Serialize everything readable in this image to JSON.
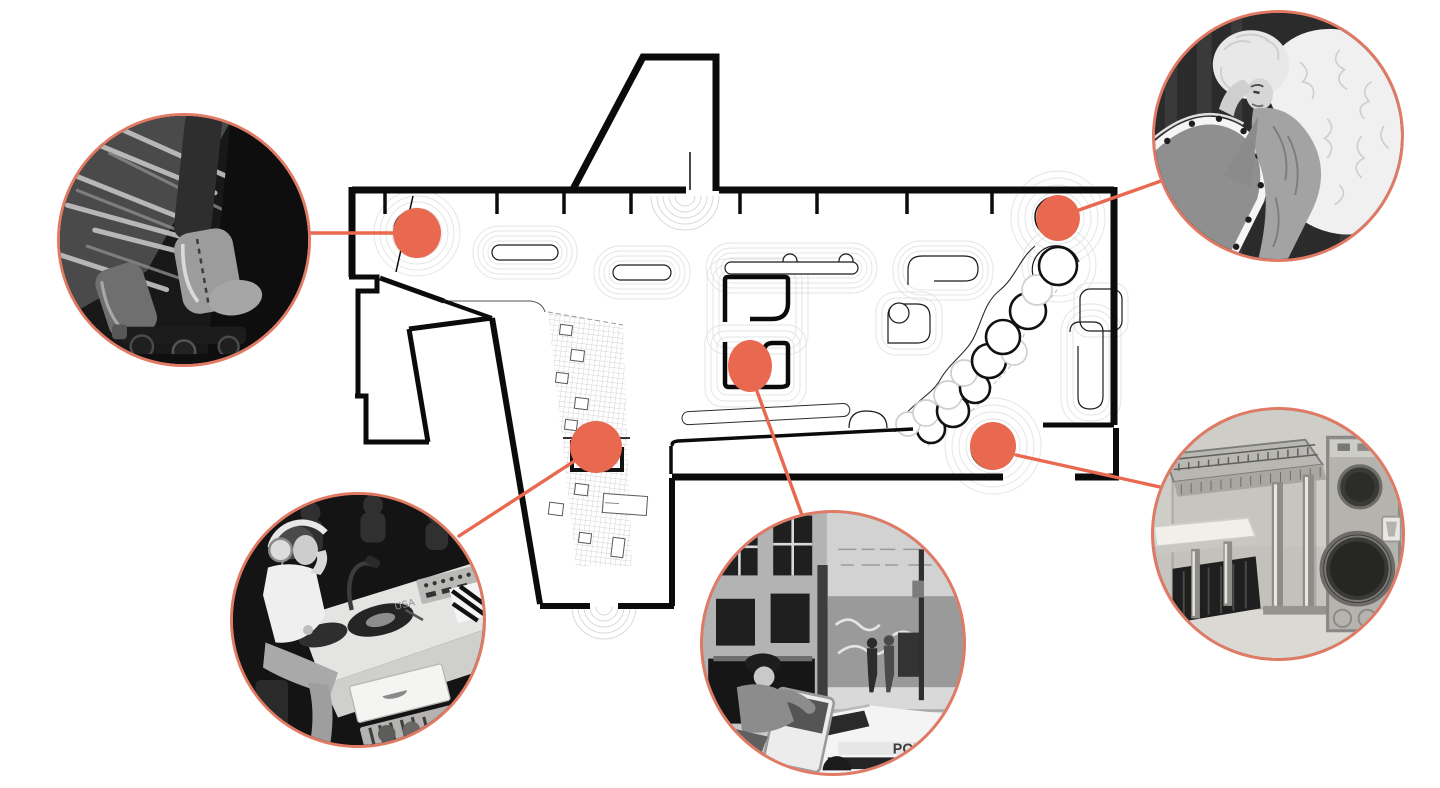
{
  "palette": {
    "accent": "#E8694F",
    "accent_border": "#E17A64",
    "wall": "#0b0b0b",
    "contour": "#dedede",
    "grid_line": "#c6c6c6"
  },
  "plan": {
    "name": "nightclub-floor-plan",
    "hotspot_count": 5
  },
  "hotspots": [
    {
      "id": "skates",
      "cx": 417,
      "cy": 233,
      "rx": 24,
      "ry": 25,
      "ring": {
        "cx": 413,
        "cy": 230,
        "r": 19
      }
    },
    {
      "id": "divine",
      "cx": 1058,
      "cy": 218,
      "rx": 22,
      "ry": 23,
      "ring": {
        "cx": 1055,
        "cy": 217,
        "r": 20
      }
    },
    {
      "id": "police",
      "cx": 750,
      "cy": 366,
      "rx": 22,
      "ry": 26
    },
    {
      "id": "dj",
      "cx": 596,
      "cy": 447,
      "rx": 26,
      "ry": 26
    },
    {
      "id": "piano",
      "cx": 993,
      "cy": 446,
      "rx": 23,
      "ry": 24,
      "ring": {
        "cx": 992,
        "cy": 448,
        "r": 21
      }
    }
  ],
  "connectors": [
    {
      "from": "skates",
      "x1": 311,
      "y1": 233,
      "x2": 417,
      "y2": 233
    },
    {
      "from": "divine",
      "x1": 1079,
      "y1": 210,
      "x2": 1161,
      "y2": 181
    },
    {
      "from": "dj",
      "x1": 459,
      "y1": 536,
      "x2": 596,
      "y2": 447
    },
    {
      "from": "police",
      "x1": 750,
      "y1": 372,
      "x2": 802,
      "y2": 515
    },
    {
      "from": "piano",
      "x1": 1016,
      "y1": 455,
      "x2": 1160,
      "y2": 487
    }
  ],
  "callouts": [
    {
      "id": "skates",
      "cx": 184,
      "cy": 240,
      "r": 127,
      "subject": "roller-skates-photo",
      "description": "black and white photo of fringed boots on roller skates"
    },
    {
      "id": "divine",
      "cx": 1278,
      "cy": 136,
      "r": 126,
      "subject": "drag-performer-photo",
      "description": "black and white photo of drag performer reclining on ruffled heart-shaped bed"
    },
    {
      "id": "dj",
      "cx": 358,
      "cy": 620,
      "r": 128,
      "subject": "dj-booth-photo",
      "description": "black and white photo of DJ with headphones at turntable console",
      "console_label": "USA"
    },
    {
      "id": "police",
      "cx": 833,
      "cy": 643,
      "r": 133,
      "subject": "street-police-car-photo",
      "description": "black and white photo of police officer and patrol car on derelict street",
      "car_label": "POLI"
    },
    {
      "id": "piano",
      "cx": 1278,
      "cy": 534,
      "r": 127,
      "subject": "transparent-piano-photo",
      "description": "photo of transparent acrylic piano with built-in round speakers"
    }
  ]
}
